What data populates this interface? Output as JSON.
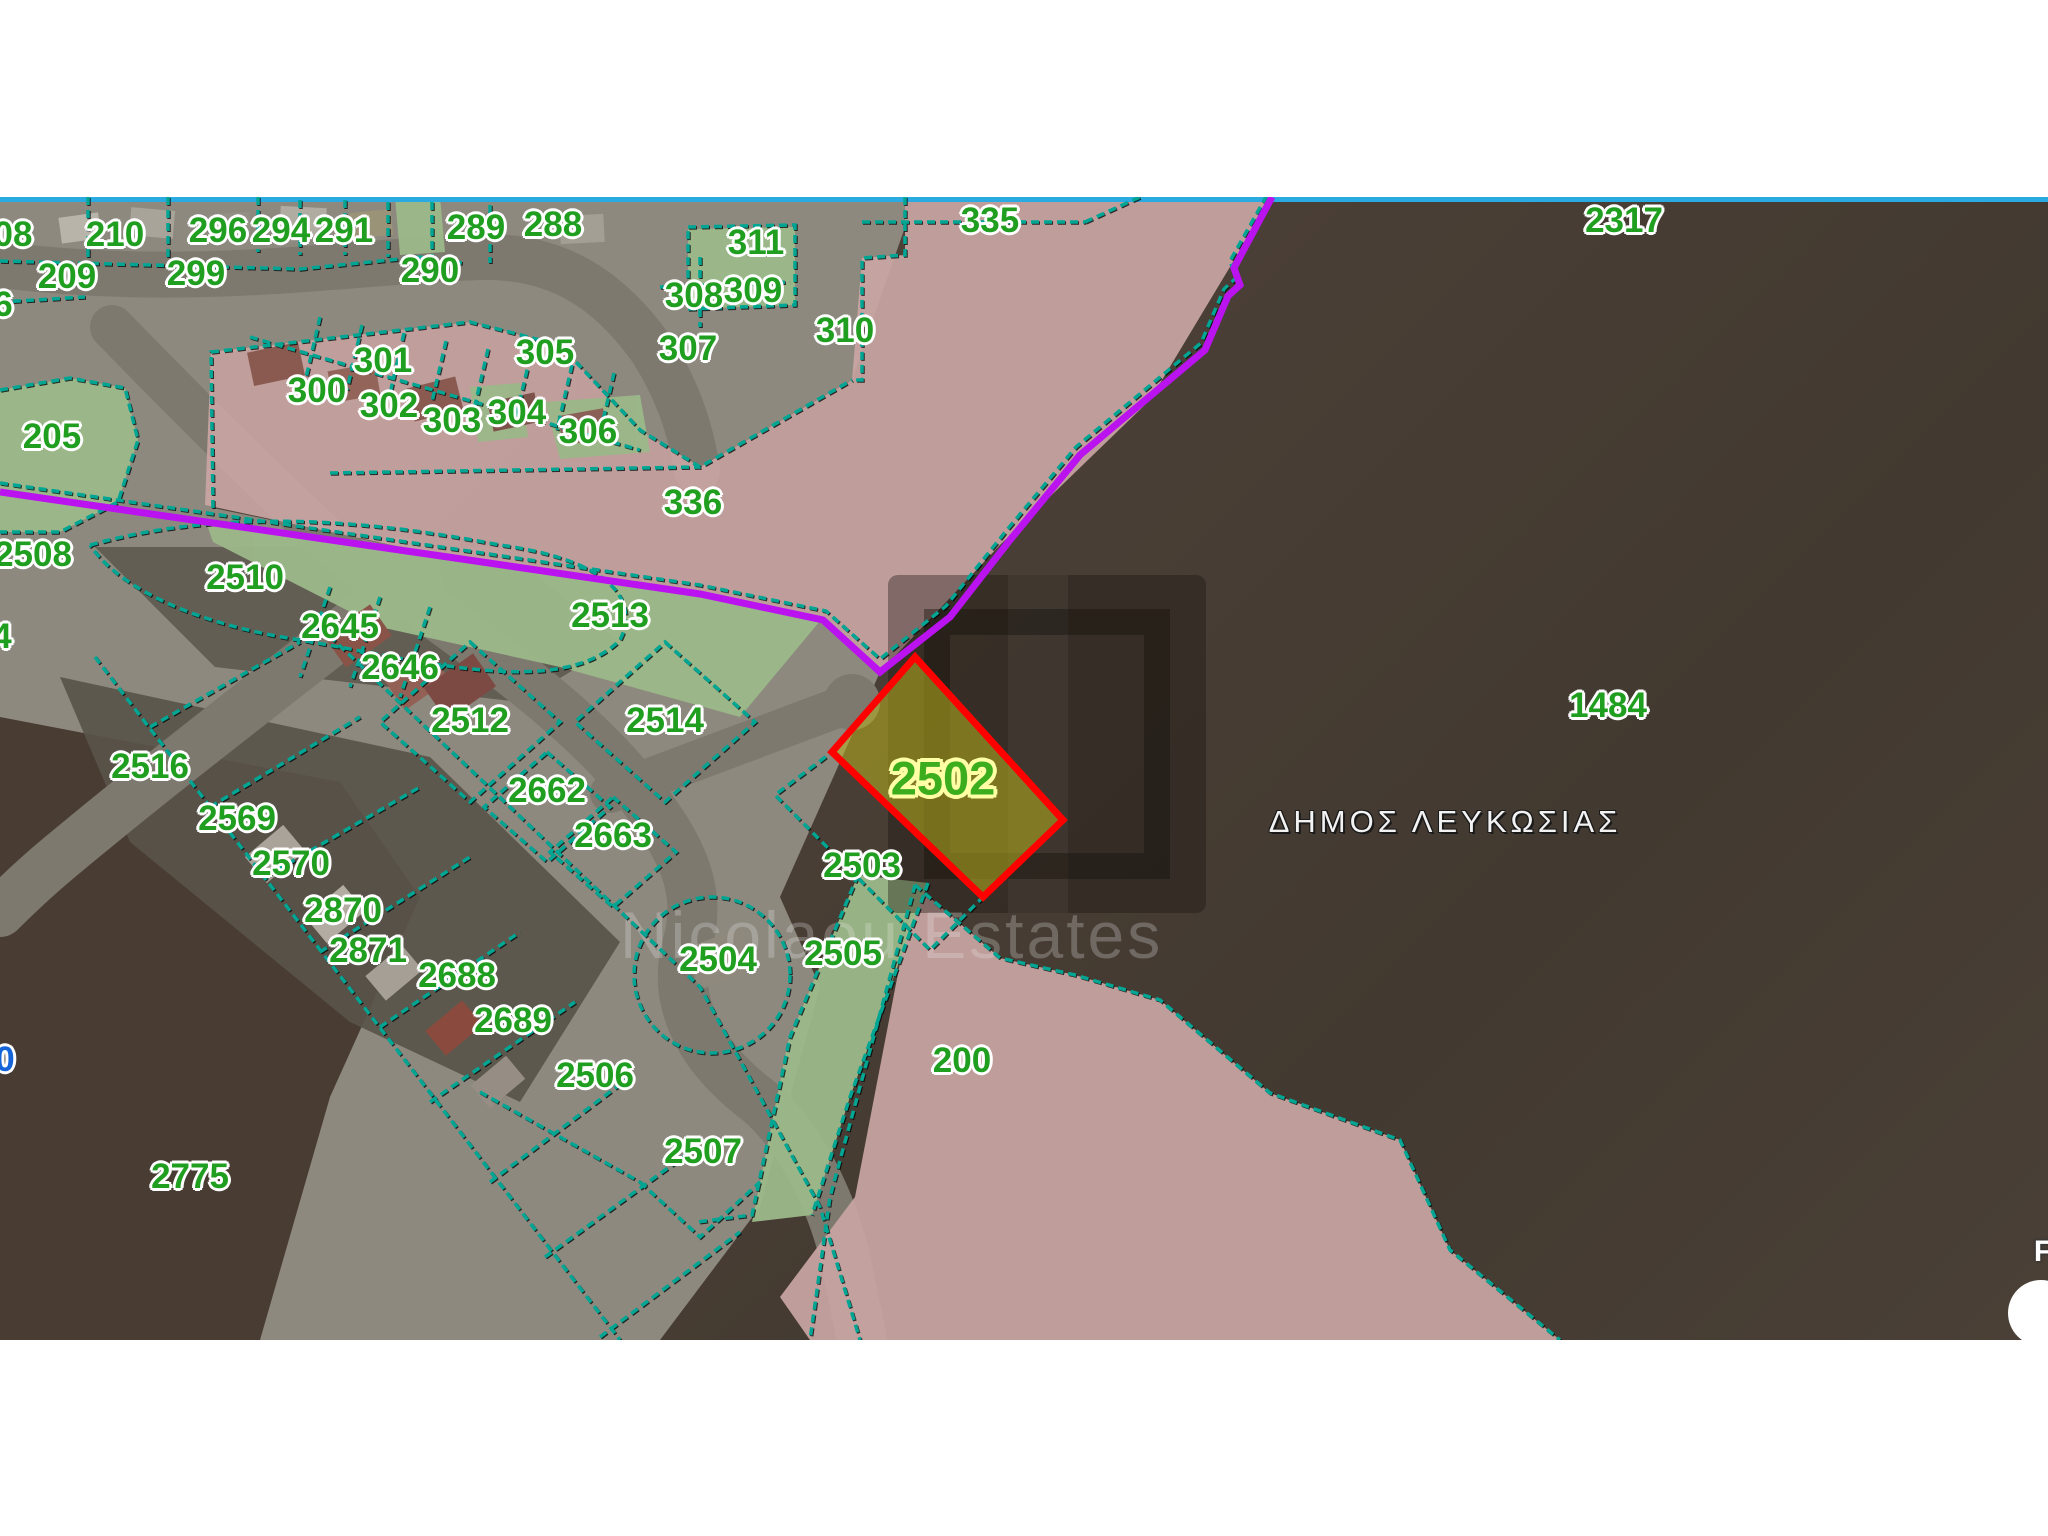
{
  "map": {
    "municipality_label": "ΔΗΜΟΣ ΛΕΥΚΩΣΙΑΣ",
    "watermark": {
      "text": "Nicolaou Estates"
    },
    "highlighted_parcel": {
      "number": "2502",
      "x": 943,
      "y": 778
    },
    "colors": {
      "parcel_label_green": "#1f9e1f",
      "boundary_teal": "#00a693",
      "municipal_boundary_purple": "#bb12f0",
      "highlight_red": "#ff0000",
      "highlight_fill_olive": "rgba(186,176,30,0.55)",
      "top_line_blue": "#29abe2",
      "zone_pink": "#c8a5a2",
      "zone_green": "#9cb889"
    },
    "labels": [
      {
        "t": "08",
        "x": 13,
        "y": 235,
        "style": "green"
      },
      {
        "t": "210",
        "x": 115,
        "y": 235,
        "style": "green"
      },
      {
        "t": "296",
        "x": 218,
        "y": 231,
        "style": "green"
      },
      {
        "t": "294",
        "x": 281,
        "y": 231,
        "style": "green"
      },
      {
        "t": "291",
        "x": 344,
        "y": 231,
        "style": "green"
      },
      {
        "t": "289",
        "x": 476,
        "y": 228,
        "style": "green"
      },
      {
        "t": "288",
        "x": 553,
        "y": 225,
        "style": "green"
      },
      {
        "t": "209",
        "x": 67,
        "y": 277,
        "style": "green"
      },
      {
        "t": "299",
        "x": 196,
        "y": 274,
        "style": "green"
      },
      {
        "t": "290",
        "x": 430,
        "y": 271,
        "style": "green"
      },
      {
        "t": "311",
        "x": 756,
        "y": 243,
        "style": "green"
      },
      {
        "t": "6",
        "x": 3,
        "y": 305,
        "style": "green"
      },
      {
        "t": "308",
        "x": 694,
        "y": 296,
        "style": "green"
      },
      {
        "t": "309",
        "x": 753,
        "y": 291,
        "style": "green"
      },
      {
        "t": "310",
        "x": 845,
        "y": 331,
        "style": "green"
      },
      {
        "t": "307",
        "x": 688,
        "y": 349,
        "style": "green"
      },
      {
        "t": "305",
        "x": 545,
        "y": 353,
        "style": "green"
      },
      {
        "t": "301",
        "x": 383,
        "y": 361,
        "style": "green"
      },
      {
        "t": "300",
        "x": 317,
        "y": 391,
        "style": "green"
      },
      {
        "t": "302",
        "x": 389,
        "y": 406,
        "style": "green"
      },
      {
        "t": "303",
        "x": 452,
        "y": 421,
        "style": "green"
      },
      {
        "t": "304",
        "x": 517,
        "y": 413,
        "style": "green"
      },
      {
        "t": "306",
        "x": 588,
        "y": 432,
        "style": "green"
      },
      {
        "t": "335",
        "x": 990,
        "y": 221,
        "style": "green"
      },
      {
        "t": "336",
        "x": 693,
        "y": 503,
        "style": "green"
      },
      {
        "t": "2317",
        "x": 1624,
        "y": 221,
        "style": "green"
      },
      {
        "t": "205",
        "x": 52,
        "y": 437,
        "style": "green"
      },
      {
        "t": "2508",
        "x": 33,
        "y": 555,
        "style": "green"
      },
      {
        "t": "2510",
        "x": 245,
        "y": 578,
        "style": "green"
      },
      {
        "t": "2645",
        "x": 340,
        "y": 627,
        "style": "green"
      },
      {
        "t": "2646",
        "x": 400,
        "y": 668,
        "style": "green"
      },
      {
        "t": "2513",
        "x": 610,
        "y": 616,
        "style": "green"
      },
      {
        "t": "4",
        "x": 2,
        "y": 637,
        "style": "green"
      },
      {
        "t": "2512",
        "x": 470,
        "y": 721,
        "style": "green"
      },
      {
        "t": "2514",
        "x": 665,
        "y": 721,
        "style": "green"
      },
      {
        "t": "2516",
        "x": 150,
        "y": 767,
        "style": "green"
      },
      {
        "t": "2569",
        "x": 237,
        "y": 819,
        "style": "green"
      },
      {
        "t": "2570",
        "x": 291,
        "y": 864,
        "style": "green"
      },
      {
        "t": "2662",
        "x": 547,
        "y": 791,
        "style": "green"
      },
      {
        "t": "2663",
        "x": 613,
        "y": 836,
        "style": "green"
      },
      {
        "t": "2870",
        "x": 343,
        "y": 911,
        "style": "green"
      },
      {
        "t": "2871",
        "x": 368,
        "y": 951,
        "style": "green"
      },
      {
        "t": "2688",
        "x": 457,
        "y": 976,
        "style": "green"
      },
      {
        "t": "2689",
        "x": 513,
        "y": 1021,
        "style": "green"
      },
      {
        "t": "2506",
        "x": 595,
        "y": 1076,
        "style": "green"
      },
      {
        "t": "2507",
        "x": 703,
        "y": 1152,
        "style": "green"
      },
      {
        "t": "2775",
        "x": 190,
        "y": 1177,
        "style": "green"
      },
      {
        "t": "2503",
        "x": 862,
        "y": 866,
        "style": "green"
      },
      {
        "t": "2504",
        "x": 718,
        "y": 960,
        "style": "green"
      },
      {
        "t": "2505",
        "x": 843,
        "y": 954,
        "style": "green"
      },
      {
        "t": "200",
        "x": 962,
        "y": 1061,
        "style": "green"
      },
      {
        "t": "1484",
        "x": 1608,
        "y": 706,
        "style": "green"
      },
      {
        "t": "2502",
        "x": 943,
        "y": 778,
        "style": "highlight"
      },
      {
        "t": "ΔΗΜΟΣ ΛΕΥΚΩΣΙΑΣ",
        "x": 1445,
        "y": 822,
        "style": "municipality"
      },
      {
        "t": "0",
        "x": 5,
        "y": 1060,
        "style": "blue"
      },
      {
        "t": "F",
        "x": 2043,
        "y": 1252,
        "style": "white-partial"
      }
    ]
  }
}
